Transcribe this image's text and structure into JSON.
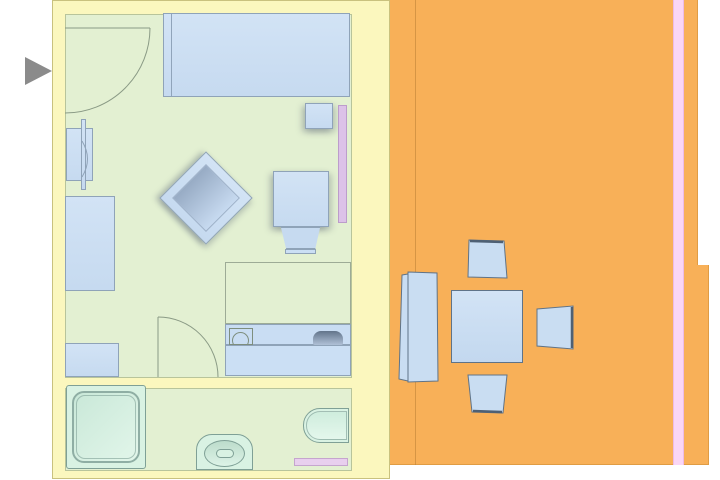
{
  "window": {
    "width": 720,
    "height": 480,
    "background": "#ffffff",
    "content": "architectural floor plan of a hotel-style room with bathroom and terrace",
    "visible_text": ""
  },
  "palette": {
    "wall_fill": "#FBF7BE",
    "wall_line": "#C9C17E",
    "room_floor": "#E3F0D2",
    "floor_line": "#96A06E",
    "terrace_fill": "#F8B058",
    "terrace_edge": "#E09C44",
    "furniture_fill": "#CBDFF4",
    "furniture_stroke": "#8FA3B8",
    "furniture_dark": "#5F7388",
    "fixture_fill": "#D9F2E3",
    "fixture_stroke": "#7FA096",
    "door_strip_room": "#DCC2E8",
    "door_strip_bath": "#E8CFEE",
    "door_strip_terrace": "#FAD6F5",
    "door_swing_line": "#8A9A85",
    "entrance_arrow": "#8B8B8B"
  },
  "plan": {
    "areas": [
      {
        "id": "bedroom",
        "label": "bedroom / living area"
      },
      {
        "id": "bathroom",
        "label": "bathroom"
      },
      {
        "id": "terrace",
        "label": "terrace"
      }
    ],
    "bedroom_items": [
      "double bed",
      "nightstand",
      "wall wardrobe with sliding panel",
      "dresser",
      "side cabinet",
      "rotated lounge chair",
      "armchair at desk",
      "desk with counter",
      "sink fixture on counter",
      "phone on counter",
      "entry door swing",
      "bathroom door swing",
      "pink door marker strip"
    ],
    "bathroom_items": [
      "shower cabin",
      "toilet",
      "bathtub",
      "pink bath mat strip"
    ],
    "terrace_items": [
      "sun lounger",
      "square dining table",
      "chair north",
      "chair east",
      "chair south",
      "pink terrace strip",
      "terrace decking line"
    ],
    "markers": [
      "entrance arrow"
    ]
  },
  "labels": {
    "stage": "floor plan drawing",
    "walls": "walls",
    "bedroom": "bedroom / living area floor",
    "bathroom": "bathroom floor",
    "terrace_upper": "terrace (upper part)",
    "terrace_lower": "terrace (lower part)",
    "terrace_line": "terrace decking line",
    "terrace_strip": "pink terrace strip",
    "bed": "double bed",
    "nightstand": "nightstand",
    "room_strip": "pink door marker strip",
    "wardrobe": "wall wardrobe",
    "wardrobe_door": "sliding panel",
    "wardrobe_arc": "wardrobe door arc",
    "dresser": "dresser",
    "cabinet": "side cabinet",
    "diamond_chair": "rotated lounge chair",
    "armchair": "armchair",
    "desk_outline": "desk outline",
    "desk_shelf": "counter shelf",
    "desk": "desk / counter",
    "sink": "sink fixture",
    "phone": "phone",
    "entry_door": "entry door swing",
    "bath_door": "bathroom door swing",
    "shower": "shower cabin",
    "toilet": "toilet",
    "bathtub": "bathtub",
    "bath_strip": "pink bath mat strip",
    "lounger": "sun lounger",
    "table": "square dining table",
    "chair_n": "terrace chair (north)",
    "chair_e": "terrace chair (east)",
    "chair_s": "terrace chair (south)",
    "arrow": "entrance arrow"
  }
}
